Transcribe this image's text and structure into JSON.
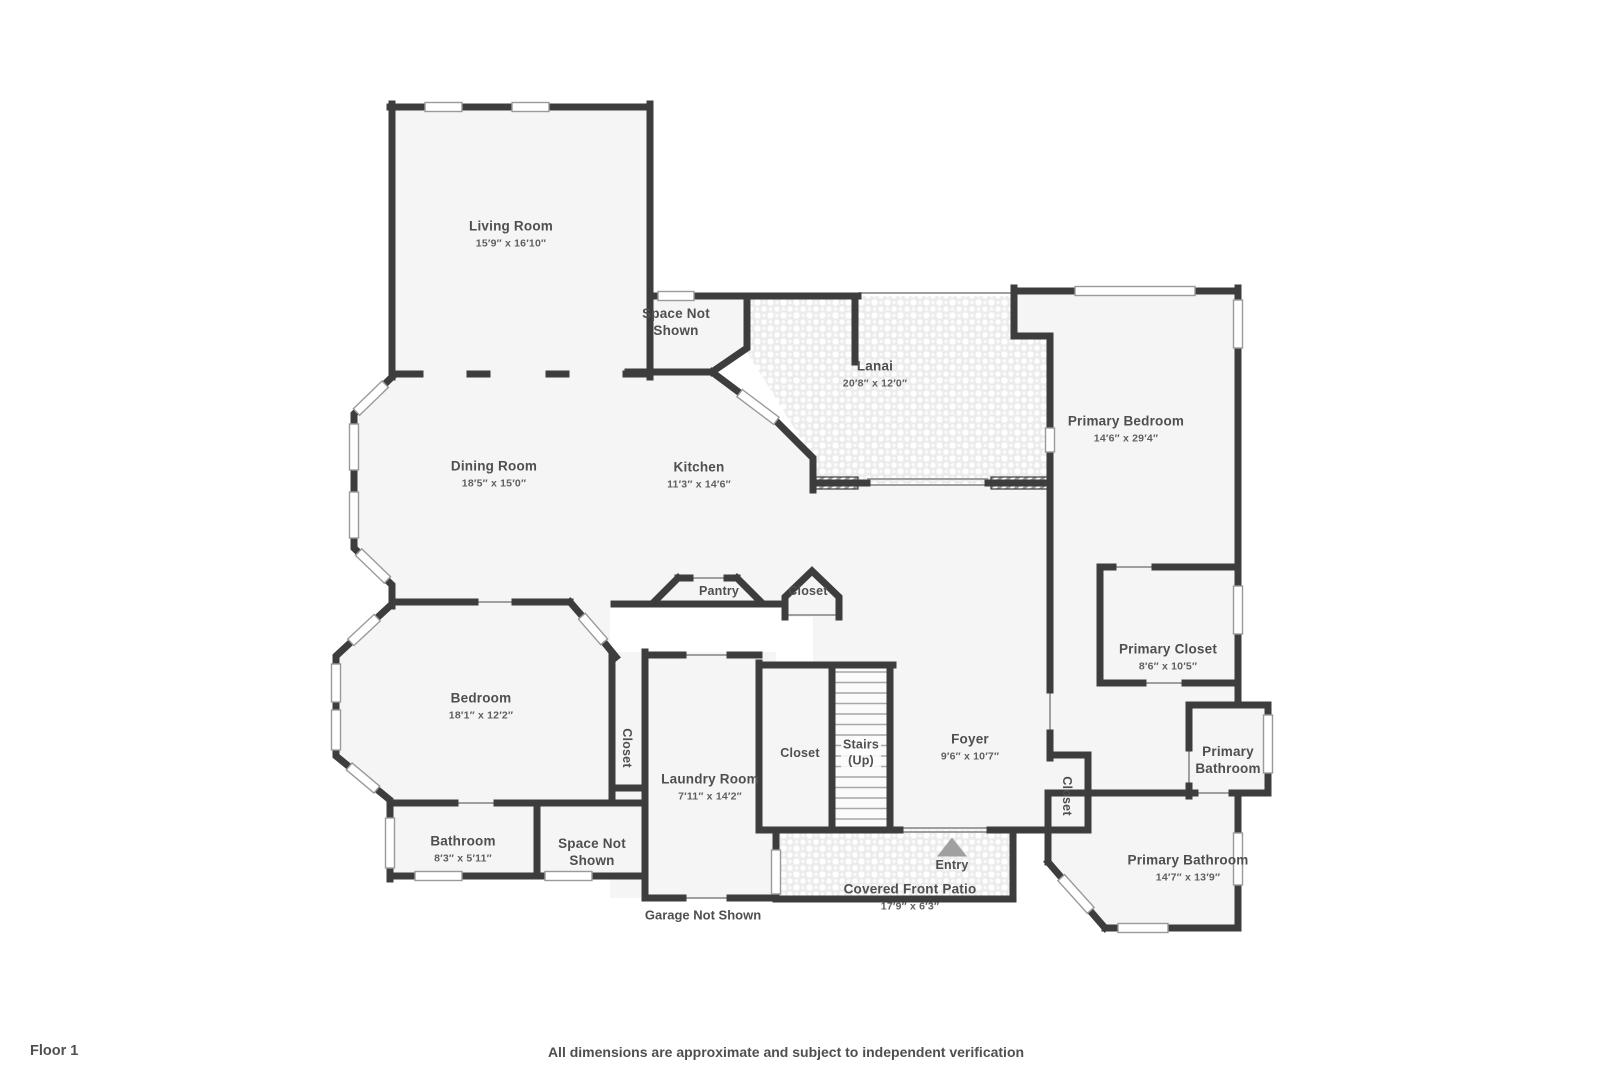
{
  "page": {
    "floor_label": "Floor 1",
    "footer": "All dimensions are approximate and subject to independent verification"
  },
  "colors": {
    "wall": "#3d3d3d",
    "room_fill": "#f5f5f5",
    "paver_fill": "#ededed",
    "label_text": "#4f4f4f",
    "entry_arrow": "#a0a0a0"
  },
  "rooms": [
    {
      "id": "living-room",
      "name": "Living Room",
      "dims": "15′9″ x 16′10″"
    },
    {
      "id": "space-not-shown-top",
      "name": "Space Not Shown",
      "dims": ""
    },
    {
      "id": "lanai",
      "name": "Lanai",
      "dims": "20′8″ x 12′0″"
    },
    {
      "id": "primary-bedroom",
      "name": "Primary Bedroom",
      "dims": "14′6″ x 29′4″"
    },
    {
      "id": "dining-room",
      "name": "Dining Room",
      "dims": "18′5″ x 15′0″"
    },
    {
      "id": "kitchen",
      "name": "Kitchen",
      "dims": "11′3″ x 14′6″"
    },
    {
      "id": "pantry",
      "name": "Pantry",
      "dims": ""
    },
    {
      "id": "closet-hall",
      "name": "Closet",
      "dims": ""
    },
    {
      "id": "primary-closet",
      "name": "Primary Closet",
      "dims": "8′6″ x 10′5″"
    },
    {
      "id": "bedroom",
      "name": "Bedroom",
      "dims": "18′1″ x 12′2″"
    },
    {
      "id": "closet-bedroom",
      "name": "Closet",
      "dims": ""
    },
    {
      "id": "laundry-room",
      "name": "Laundry Room",
      "dims": "7′11″ x 14′2″"
    },
    {
      "id": "closet-stairs",
      "name": "Closet",
      "dims": ""
    },
    {
      "id": "stairs",
      "name": "Stairs",
      "dims": "(Up)"
    },
    {
      "id": "foyer",
      "name": "Foyer",
      "dims": "9′6″ x 10′7″"
    },
    {
      "id": "closet-foyer",
      "name": "Closet",
      "dims": ""
    },
    {
      "id": "primary-bathroom-small",
      "name": "Primary Bathroom",
      "dims": ""
    },
    {
      "id": "bathroom",
      "name": "Bathroom",
      "dims": "8′3″ x 5′11″"
    },
    {
      "id": "space-not-shown-bottom",
      "name": "Space Not Shown",
      "dims": ""
    },
    {
      "id": "covered-front-patio",
      "name": "Covered Front Patio",
      "dims": "17′9″ x 6′3″"
    },
    {
      "id": "entry",
      "name": "Entry",
      "dims": ""
    },
    {
      "id": "primary-bathroom",
      "name": "Primary Bathroom",
      "dims": "14′7″ x 13′9″"
    },
    {
      "id": "garage",
      "name": "Garage Not Shown",
      "dims": ""
    }
  ]
}
